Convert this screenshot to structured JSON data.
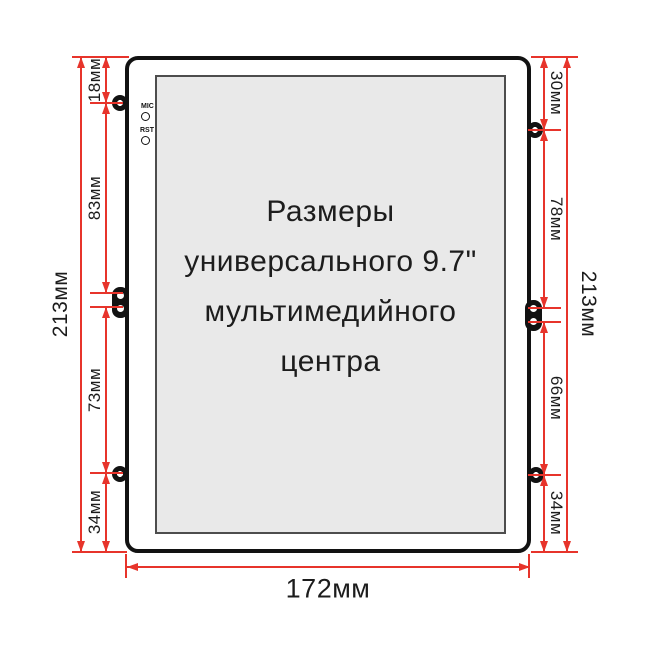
{
  "title": {
    "lines": [
      "Размеры",
      "универсального 9.7\"",
      "мультимедийного",
      "центра"
    ]
  },
  "device_labels": {
    "mic": "MIC",
    "rst": "RST"
  },
  "dimensions": {
    "left_total": "213мм",
    "left_segments": [
      "18мм",
      "83мм",
      "73мм",
      "34мм"
    ],
    "right_total": "213мм",
    "right_segments": [
      "30мм",
      "78мм",
      "66мм",
      "34мм"
    ],
    "bottom_width": "172мм",
    "unit": "мм"
  },
  "colors": {
    "dimension_red": "#e7342b",
    "outline_black": "#121212",
    "screen_fill": "#e9e9e9"
  }
}
